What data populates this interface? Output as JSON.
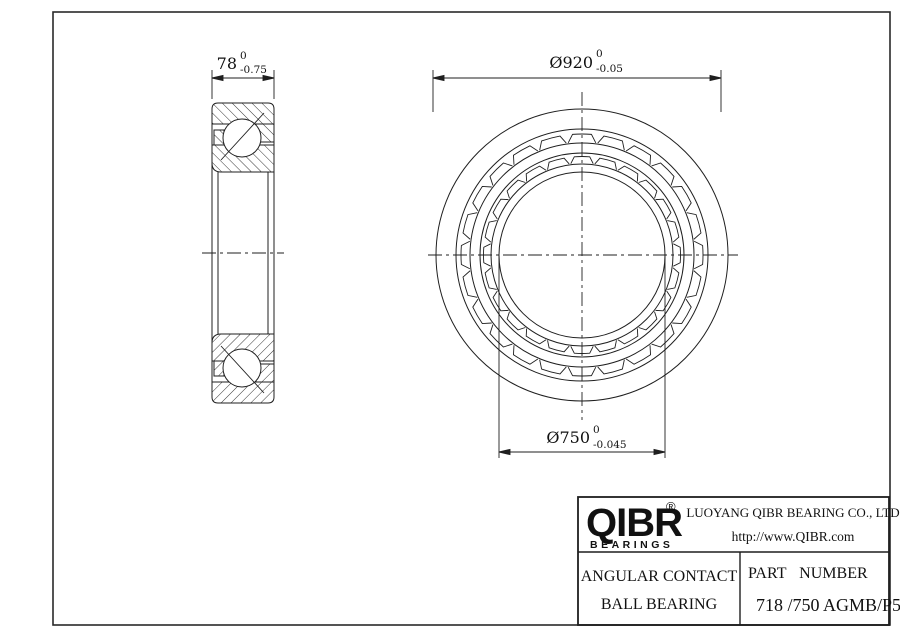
{
  "drawing": {
    "dim_width": {
      "value": "78",
      "tol_upper": "0",
      "tol_lower": "-0.75"
    },
    "dim_outer": {
      "value": "Ø920",
      "tol_upper": "0",
      "tol_lower": "-0.05"
    },
    "dim_bore": {
      "value": "Ø750",
      "tol_upper": "0",
      "tol_lower": "-0.045"
    }
  },
  "title_block": {
    "brand": "QIBR",
    "registered": "®",
    "brand_sub": "BEARINGS",
    "company": "LUOYANG QIBR BEARING CO., LTD",
    "website": "http://www.QIBR.com",
    "product_line1": "ANGULAR CONTACT",
    "product_line2": "BALL BEARING",
    "part_label": "PART NUMBER",
    "part_number": "718 /750 AGMB/P5"
  },
  "colors": {
    "line": "#1f1f1f",
    "background": "#ffffff"
  }
}
